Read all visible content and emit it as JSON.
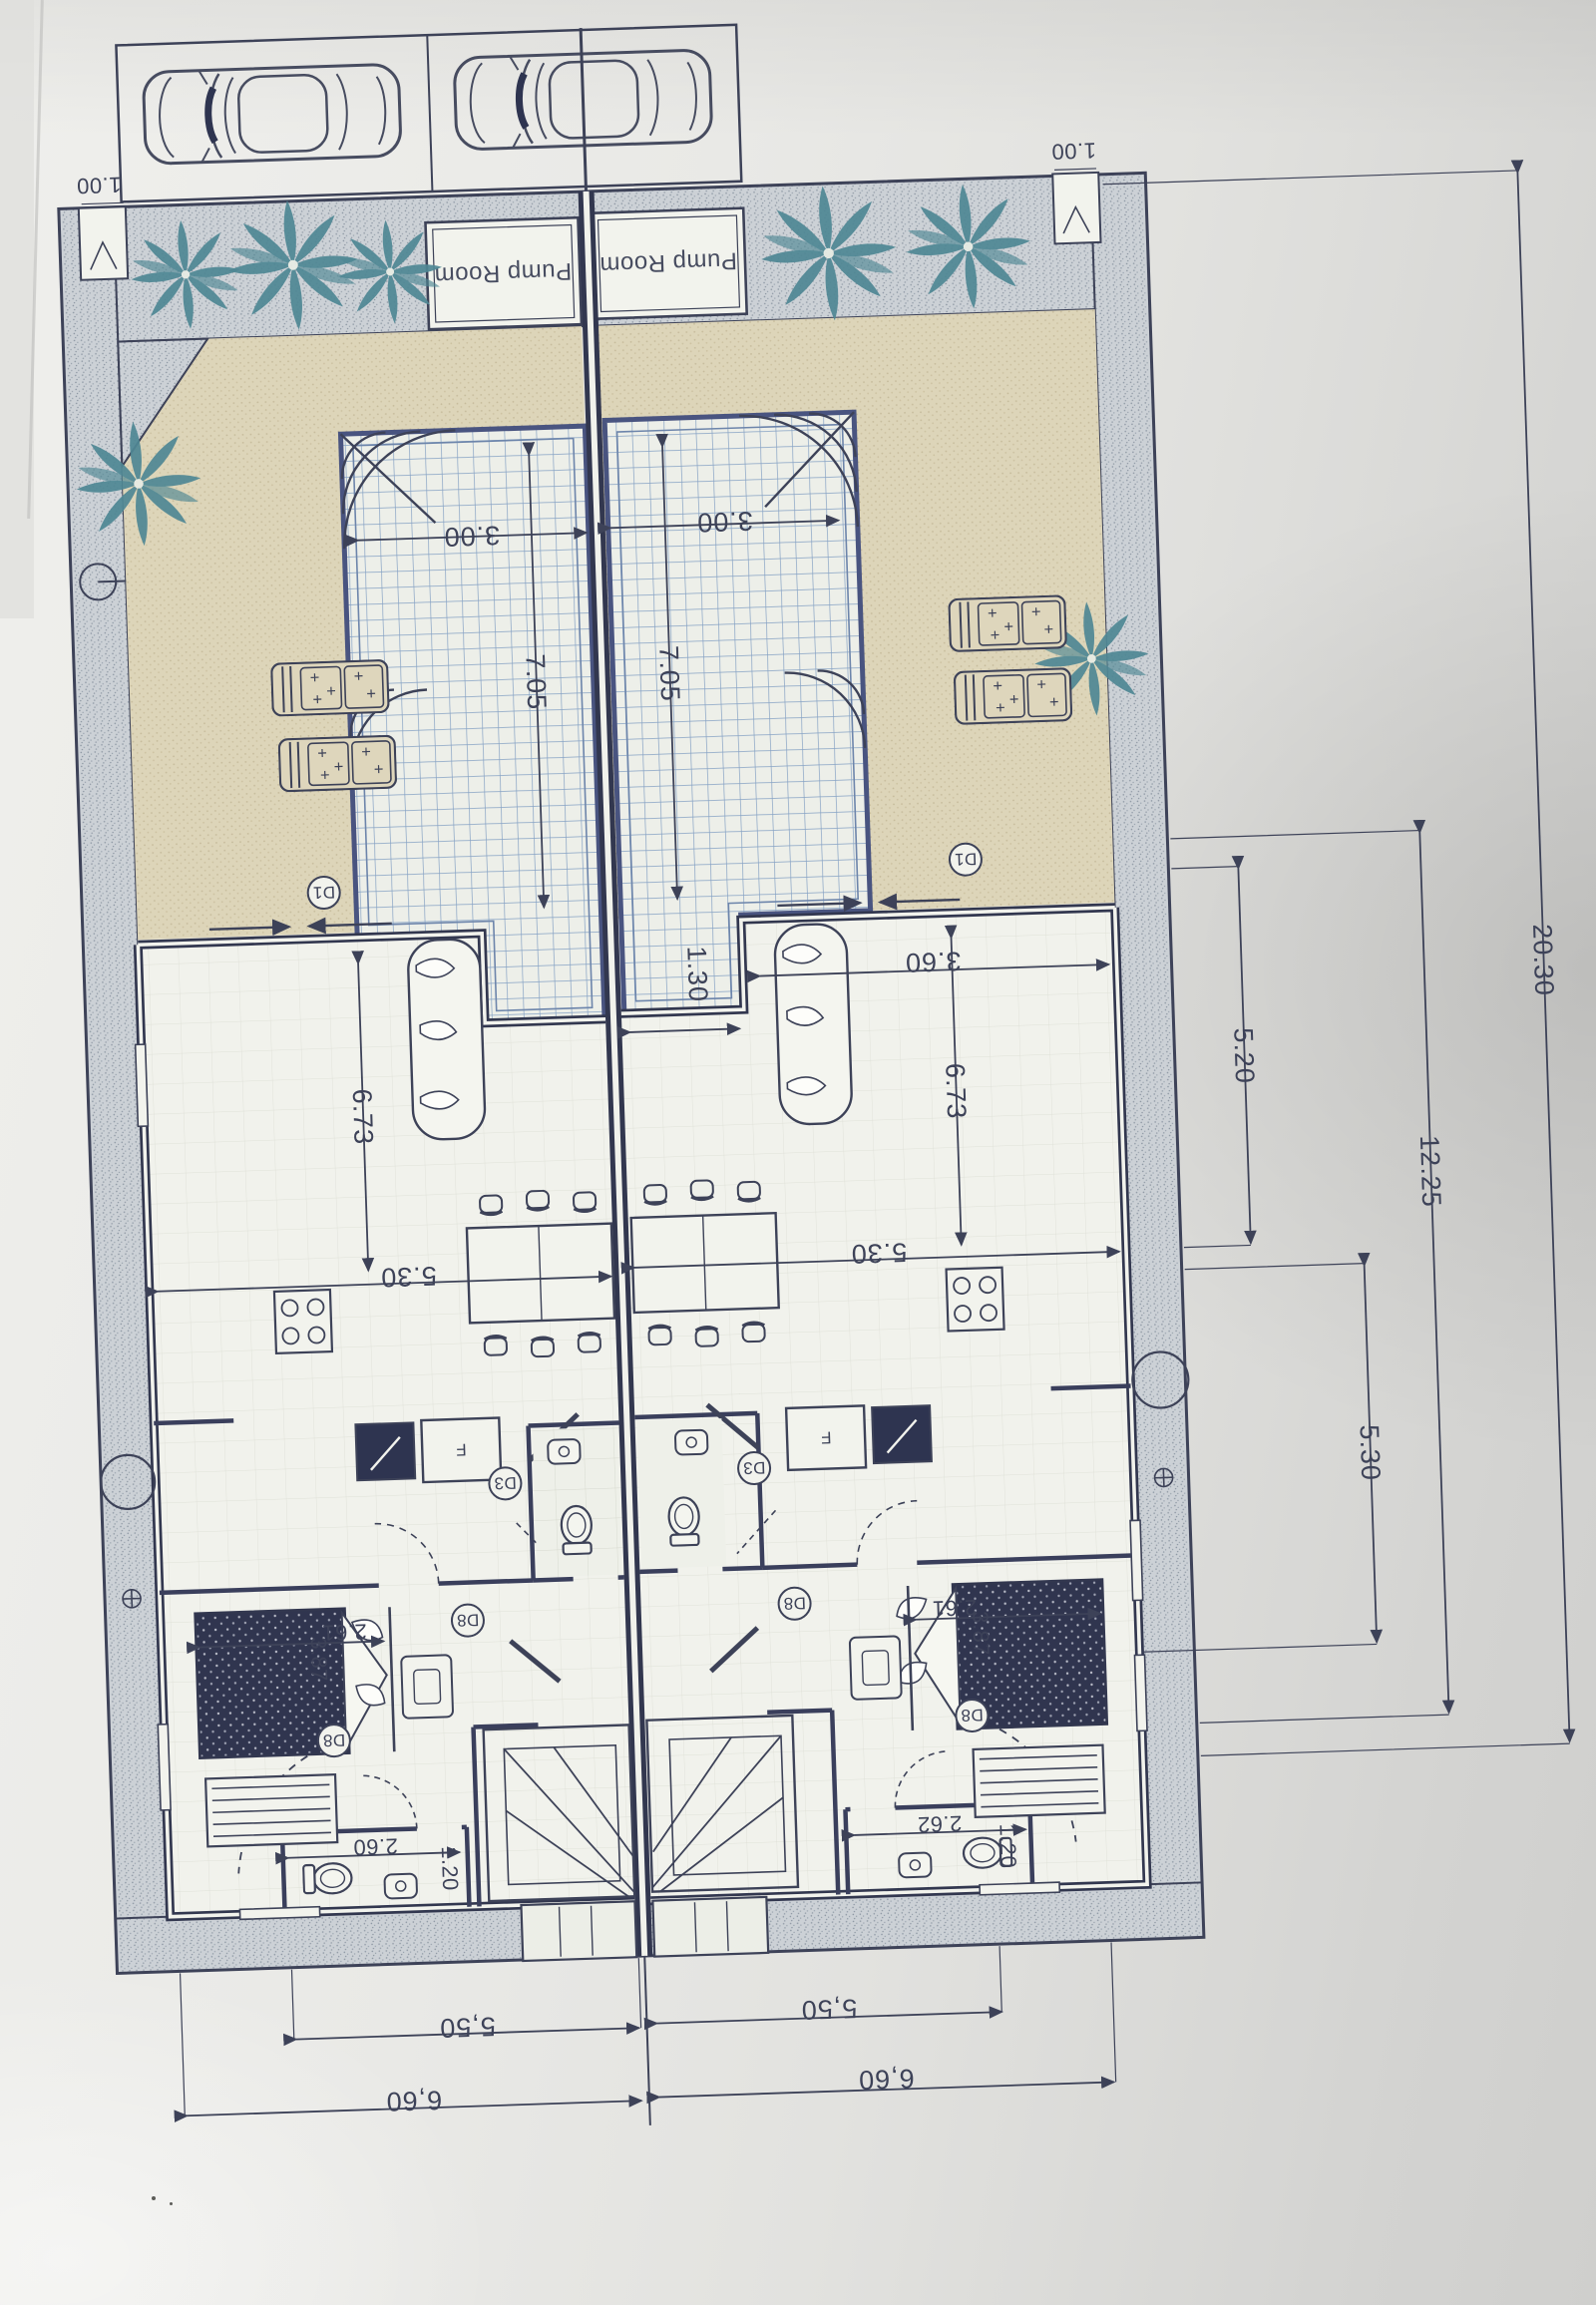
{
  "drawing": {
    "kind": "twin-villa ground floor plan photo, rotated 180 degrees",
    "labels": {
      "pump_room": "Pump Room",
      "fridge": "F"
    },
    "door_tags": {
      "deck_door": "D1",
      "wc_door": "D3",
      "foyer_door": "D8"
    },
    "dimensions": {
      "gate_width": "1.00",
      "pool_width": "3.00",
      "pool_length": "7.05",
      "pool_nook_width": "1.30",
      "living_length": "6.73",
      "living_width": "5.30",
      "lounge_width": "3.60",
      "bed_width": "2.61",
      "bedroom_length": "3.87",
      "bath_width_left": "2.60",
      "bath_width_right": "2.62",
      "bath_depth": "1.20",
      "unit_width_inner": "5,50",
      "unit_width_outer": "6,60",
      "side_upper": "5.20",
      "side_lower": "5.30",
      "side_building": "12.25",
      "site_depth": "20.30"
    },
    "colors": {
      "ink": "#3d4258",
      "wall": "#32374f",
      "pool_line": "#7e9cc0",
      "palm": "#4f8794",
      "deck": "#ddd5b9",
      "boundary": "#ccd1d6",
      "paper": "#e9e9e6"
    },
    "counts": {
      "cars": 2,
      "pools": 2,
      "pump_rooms": 2,
      "villas": 2
    }
  }
}
